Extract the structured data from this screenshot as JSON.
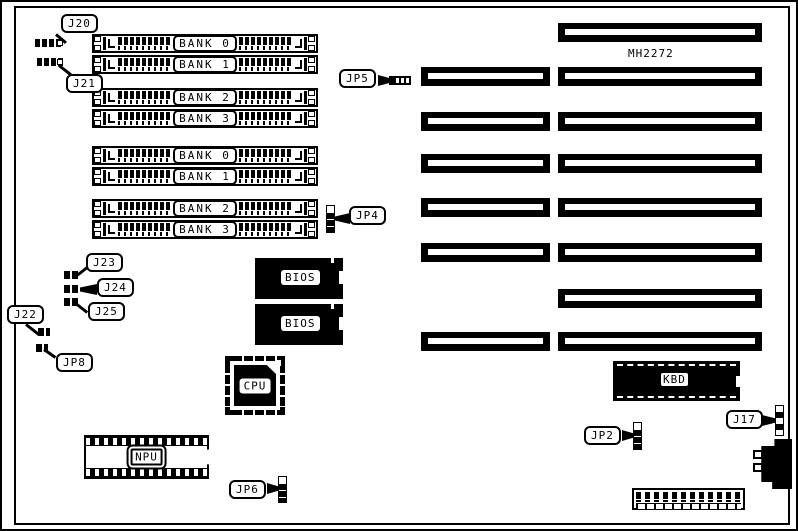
{
  "board": {
    "model": "MH2272",
    "simm_banks": [
      "BANK 0",
      "BANK 1",
      "BANK 2",
      "BANK 3",
      "BANK 0",
      "BANK 1",
      "BANK 2",
      "BANK 3"
    ],
    "chips": {
      "bios_top": "BIOS",
      "bios_bottom": "BIOS",
      "cpu": "CPU",
      "npu": "NPU",
      "kbd": "KBD"
    },
    "jumpers": {
      "j20": "J20",
      "j21": "J21",
      "j22": "J22",
      "j23": "J23",
      "j24": "J24",
      "j25": "J25",
      "jp2": "JP2",
      "jp4": "JP4",
      "jp5": "JP5",
      "jp6": "JP6",
      "jp8": "JP8",
      "j17": "J17"
    },
    "colors": {
      "ink": "#000000",
      "paper": "#ffffff"
    }
  }
}
